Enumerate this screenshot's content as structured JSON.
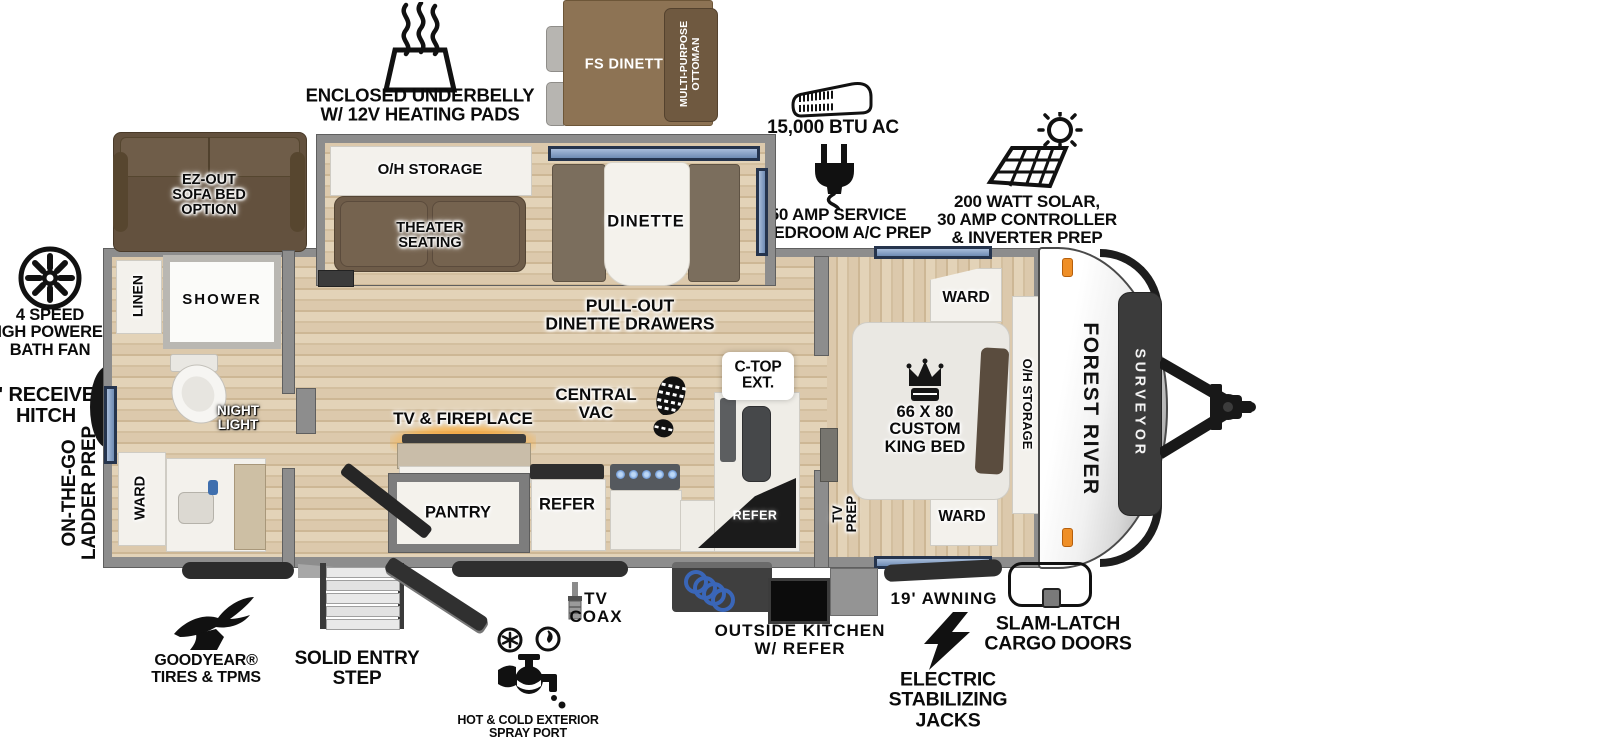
{
  "brand": {
    "maker": "FOREST RIVER",
    "model": "SURVEYOR"
  },
  "callouts": {
    "underbelly": "ENCLOSED UNDERBELLY\nW/ 12V HEATING PADS",
    "ac": "15,000 BTU AC",
    "service": "50 AMP SERVICE\n& BEDROOM A/C PREP",
    "solar": "200 WATT SOLAR,\n30 AMP CONTROLLER\n& INVERTER PREP",
    "bath_fan": "4 SPEED\nHIGH POWERED\nBATH FAN",
    "receiver_hitch": "2\" RECEIVER\nHITCH",
    "ladder_prep": "ON-THE-GO\nLADDER PREP",
    "goodyear": "GOODYEAR®\nTIRES & TPMS",
    "entry_step": "SOLID ENTRY\nSTEP",
    "spray_port": "HOT & COLD EXTERIOR\nSPRAY PORT",
    "tv_coax": "TV\nCOAX",
    "outside_kitchen": "OUTSIDE KITCHEN\nW/ REFER",
    "awning": "19' AWNING",
    "stab_jacks": "ELECTRIC\nSTABILIZING\nJACKS",
    "cargo_doors": "SLAM-LATCH\nCARGO DOORS"
  },
  "rooms": {
    "ez_sofa": "EZ-OUT\nSOFA BED\nOPTION",
    "fs_dinette": "FS DINETTE",
    "ottoman": "MULTI-PURPOSE\nOTTOMAN",
    "oh_storage_slide": "O/H STORAGE",
    "theater_seating": "THEATER\nSEATING",
    "dinette": "DINETTE",
    "pullout_drawers": "PULL-OUT\nDINETTE DRAWERS",
    "central_vac": "CENTRAL\nVAC",
    "ctop_ext": "C-TOP\nEXT.",
    "tv_fireplace": "TV & FIREPLACE",
    "pantry": "PANTRY",
    "refer": "REFER",
    "outside_refer": "REFER",
    "linen": "LINEN",
    "shower": "SHOWER",
    "night_light": "NIGHT\nLIGHT",
    "ward_bath": "WARD",
    "ward_front_top": "WARD",
    "ward_front_bottom": "WARD",
    "king_bed": "66 X 80\nCUSTOM\nKING BED",
    "oh_storage_bed": "O/H STORAGE",
    "tv_prep": "TV\nPREP"
  }
}
